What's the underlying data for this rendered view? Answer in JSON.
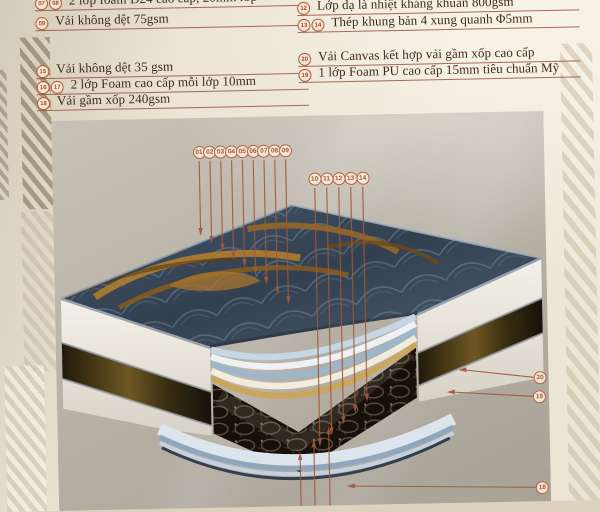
{
  "document_type": "mattress layer specification diagram (photographed print, Vietnamese)",
  "colors": {
    "page_bg": "#e9e1d0",
    "panel_bg": "#b8b2a7",
    "accent_red_brown": "#a2563e",
    "text_brown": "#40291b",
    "mattress_top_blue": "#3a4a5c",
    "gold_swirl": "#a8742c",
    "coil_dark": "#161009"
  },
  "spec_left": {
    "rows": [
      {
        "badges": [
          "07",
          "08"
        ],
        "text": "2 lớp foam D24 cao cấp, 20mm lớp"
      },
      {
        "badges": [
          "09"
        ],
        "text": "Vải không dệt 75gsm"
      },
      {
        "badges": [
          "15"
        ],
        "text": "Vải không dệt 35 gsm"
      },
      {
        "badges": [
          "16",
          "17"
        ],
        "text": "2 lớp Foam cao cấp mỗi lớp 10mm"
      },
      {
        "badges": [
          "18"
        ],
        "text": "Vải gầm xốp 240gsm"
      }
    ]
  },
  "spec_right": {
    "rows": [
      {
        "badges": [
          "12"
        ],
        "text": "Lớp dạ là nhiệt kháng khuẩn 800gsm"
      },
      {
        "badges": [
          "13",
          "14"
        ],
        "text": "Thép khung bản 4 xung quanh Φ5mm"
      },
      {
        "badges": [
          "20"
        ],
        "text": "Vải Canvas kết hợp vải gầm xốp cao cấp"
      },
      {
        "badges": [
          "19"
        ],
        "text": "1 lớp Foam PU cao cấp 15mm tiêu chuẩn Mỹ"
      }
    ]
  },
  "diagram": {
    "callouts_top": [
      "01",
      "02",
      "03",
      "04",
      "05",
      "06",
      "07",
      "08",
      "09"
    ],
    "callouts_mid": [
      "10",
      "11",
      "12",
      "13",
      "14"
    ],
    "callouts_side": [
      "20",
      "19"
    ],
    "callout_bottom": "18"
  }
}
